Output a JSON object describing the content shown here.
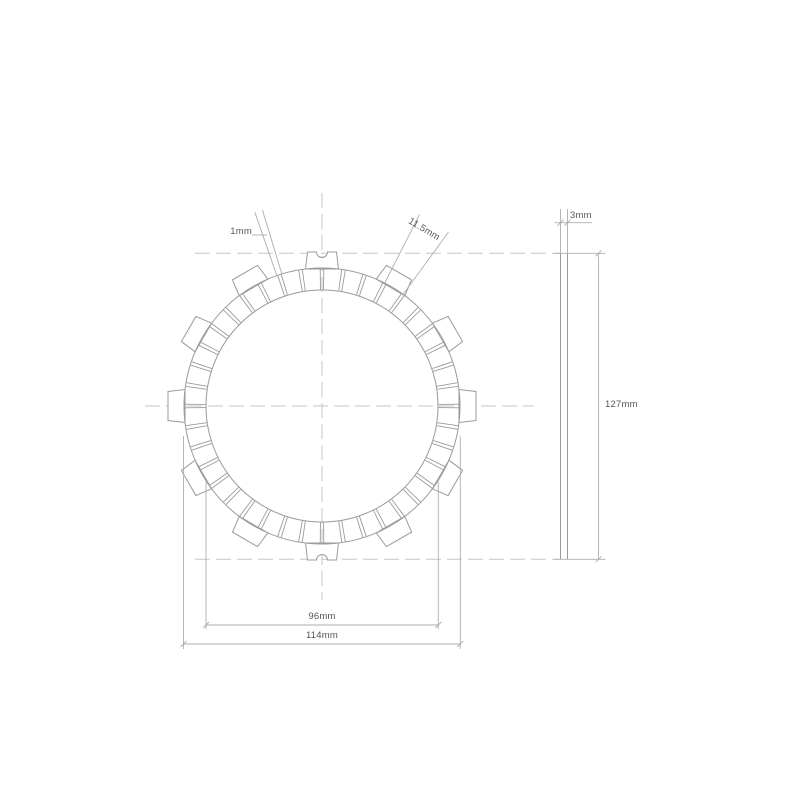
{
  "page": {
    "background": "#ffffff"
  },
  "drawing": {
    "type": "technical-drawing",
    "subject": "clutch friction plate - front and side view",
    "front_view": {
      "center_x": 322,
      "center_y": 406,
      "ring_outer_r": 138,
      "ring_inner_r": 116,
      "tab_outer_r": 154,
      "tab_base_r": 137,
      "tab_count": 12,
      "tab_angle_step_deg": 30,
      "tab_outer_halfwidth": 14.5,
      "tab_base_halfwidth": 16.5,
      "notched_tab_angles_deg": [
        0,
        180
      ],
      "notch_radius": 5.5,
      "pad_slot_count": 40,
      "pad_pitch_deg": 9,
      "slot_half_angle_deg": 0.75
    },
    "side_view": {
      "left": 560.5,
      "right": 567.5,
      "top": 253.3,
      "bottom": 559.3
    },
    "dimensions": [
      {
        "id": "slot-width",
        "label": "1mm"
      },
      {
        "id": "pad-width",
        "label": "11.5mm"
      },
      {
        "id": "thickness",
        "label": "3mm"
      },
      {
        "id": "overall-diameter",
        "label": "127mm"
      },
      {
        "id": "inner-ring-diameter",
        "label": "96mm"
      },
      {
        "id": "friction-ring-diameter",
        "label": "114mm"
      }
    ],
    "colors": {
      "geometry_line": "#9b9b9b",
      "dimension_line": "#aeaeae",
      "centerline": "#c6c6c6",
      "text": "#555555",
      "background": "#ffffff"
    }
  }
}
